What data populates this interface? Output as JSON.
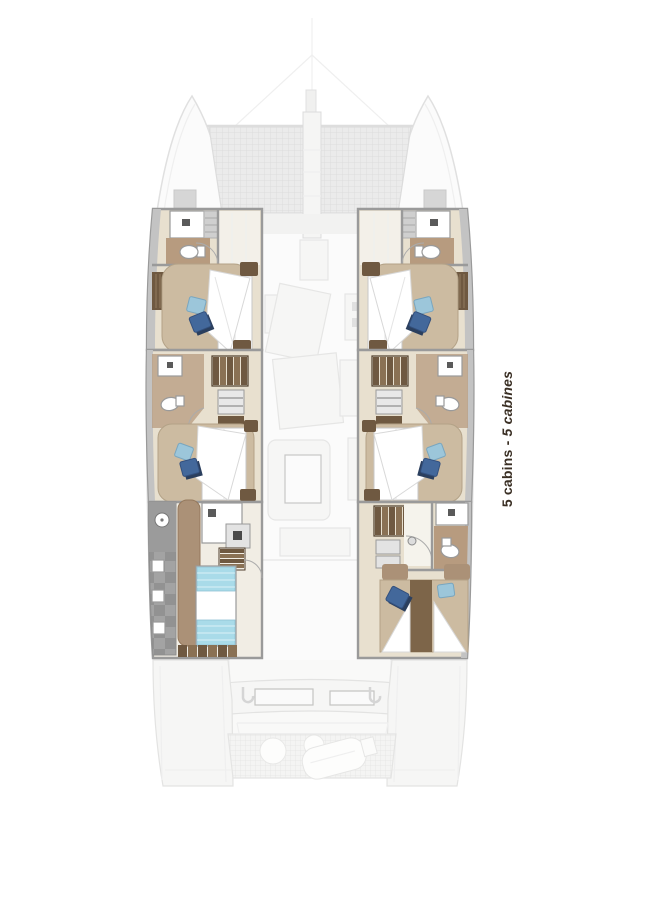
{
  "caption": {
    "en": "5 cabins",
    "separator": " - ",
    "fr": "5 cabines"
  },
  "palette": {
    "wall": "#9a9a9a",
    "gray_strip": "#c3c3c3",
    "floor_tan": "#e8e0cf",
    "floor_light": "#f1ede4",
    "bath_brown": "#b79b7f",
    "wood": "#ab9177",
    "wood_dark": "#6f5941",
    "slat_light": "#8a7154",
    "platform_tan": "#ccbba1",
    "pillow_light": "#9cc6da",
    "pillow_dark": "#43689b",
    "pillow_navy": "#2b3f5e",
    "berth_blue": "#a9dbe9",
    "tile_a": "#a3a3a3",
    "tile_b": "#929292",
    "deck_fill": "#fbfbfb",
    "hull_stroke": "#e0e0e0",
    "faint_fill": "#f6f6f5",
    "faint_stroke": "#e3e3e2",
    "tramp_bg": "#ebebeb",
    "tramp_line": "#dcdcdc",
    "caption_color": "#3a2f24"
  }
}
